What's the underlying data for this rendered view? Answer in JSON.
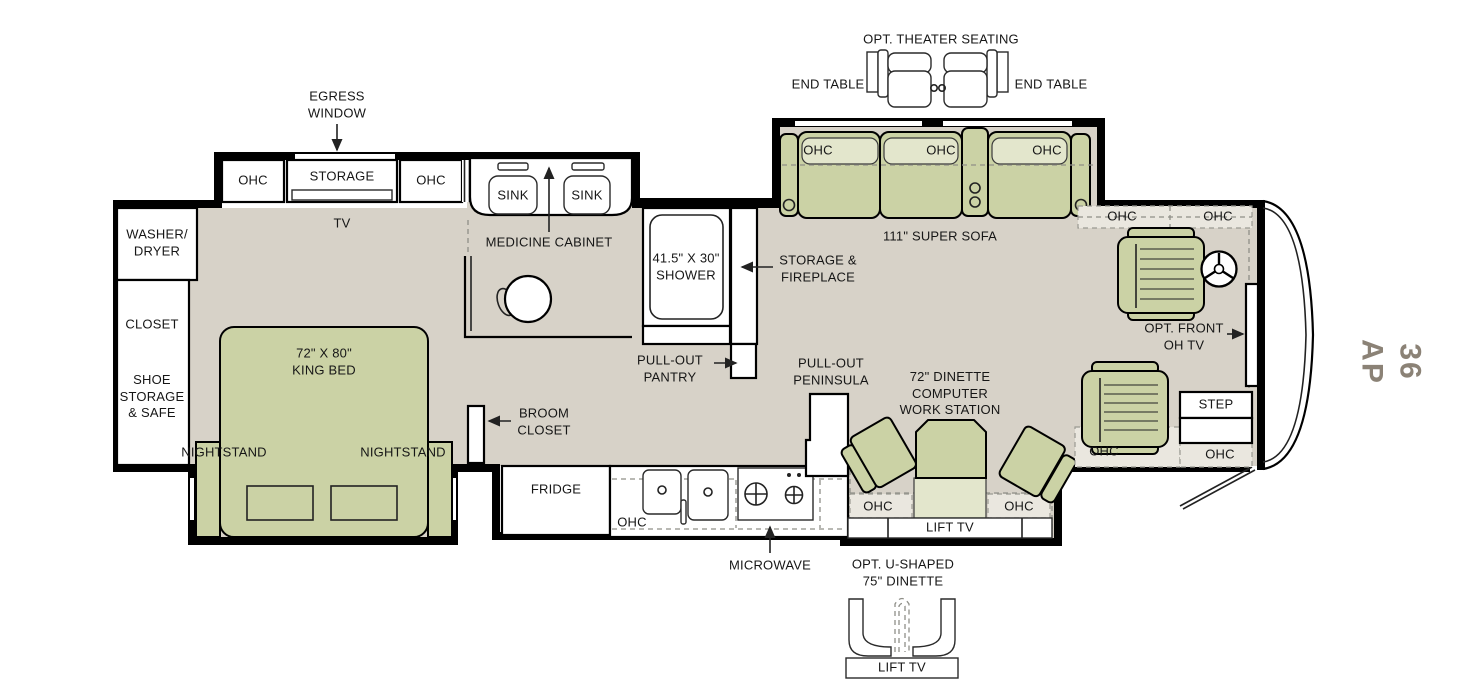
{
  "labels": {
    "theater": "OPT. THEATER SEATING",
    "end_table_left": "END TABLE",
    "end_table_right": "END TABLE",
    "egress_window": "EGRESS\nWINDOW",
    "bed_ohc_left": "OHC",
    "bed_storage": "STORAGE",
    "bed_ohc_right": "OHC",
    "bed_tv": "TV",
    "washer_dryer": "WASHER/\nDRYER",
    "closet": "CLOSET",
    "shoe_storage": "SHOE\nSTORAGE\n& SAFE",
    "king_bed": "72\" X 80\"\nKING BED",
    "nightstand_left": "NIGHTSTAND",
    "nightstand_right": "NIGHTSTAND",
    "sink_left": "SINK",
    "sink_right": "SINK",
    "medicine_cabinet": "MEDICINE CABINET",
    "shower": "41.5\" X 30\"\nSHOWER",
    "storage_fireplace": "STORAGE &\nFIREPLACE",
    "pull_out_pantry": "PULL-OUT\nPANTRY",
    "broom_closet": "BROOM\nCLOSET",
    "sofa_ohc_1": "OHC",
    "sofa_ohc_2": "OHC",
    "sofa_ohc_3": "OHC",
    "super_sofa": "111\" SUPER SOFA",
    "fridge": "FRIDGE",
    "kitchen_ohc": "OHC",
    "microwave": "MICROWAVE",
    "pull_out_peninsula": "PULL-OUT\nPENINSULA",
    "dinette": "72\" DINETTE\nCOMPUTER\nWORK STATION",
    "dinette_ohc_left": "OHC",
    "dinette_ohc_right": "OHC",
    "dinette_lift_tv": "LIFT TV",
    "cab_ohc_left": "OHC",
    "cab_ohc_right": "OHC",
    "front_oh_tv": "OPT. FRONT\nOH TV",
    "step": "STEP",
    "entry_ohc_left": "OHC",
    "entry_ohc_right": "OHC",
    "u_dinette": "OPT. U-SHAPED\n75\" DINETTE",
    "u_dinette_lift_tv": "LIFT TV",
    "plan_code": "36 AP"
  },
  "colors": {
    "floor": "#d7d2c8",
    "furniture_green": "#cbd2a5",
    "furniture_green_light": "#e3e6cc",
    "wall": "#000000",
    "plan_code": "#8b8276"
  }
}
